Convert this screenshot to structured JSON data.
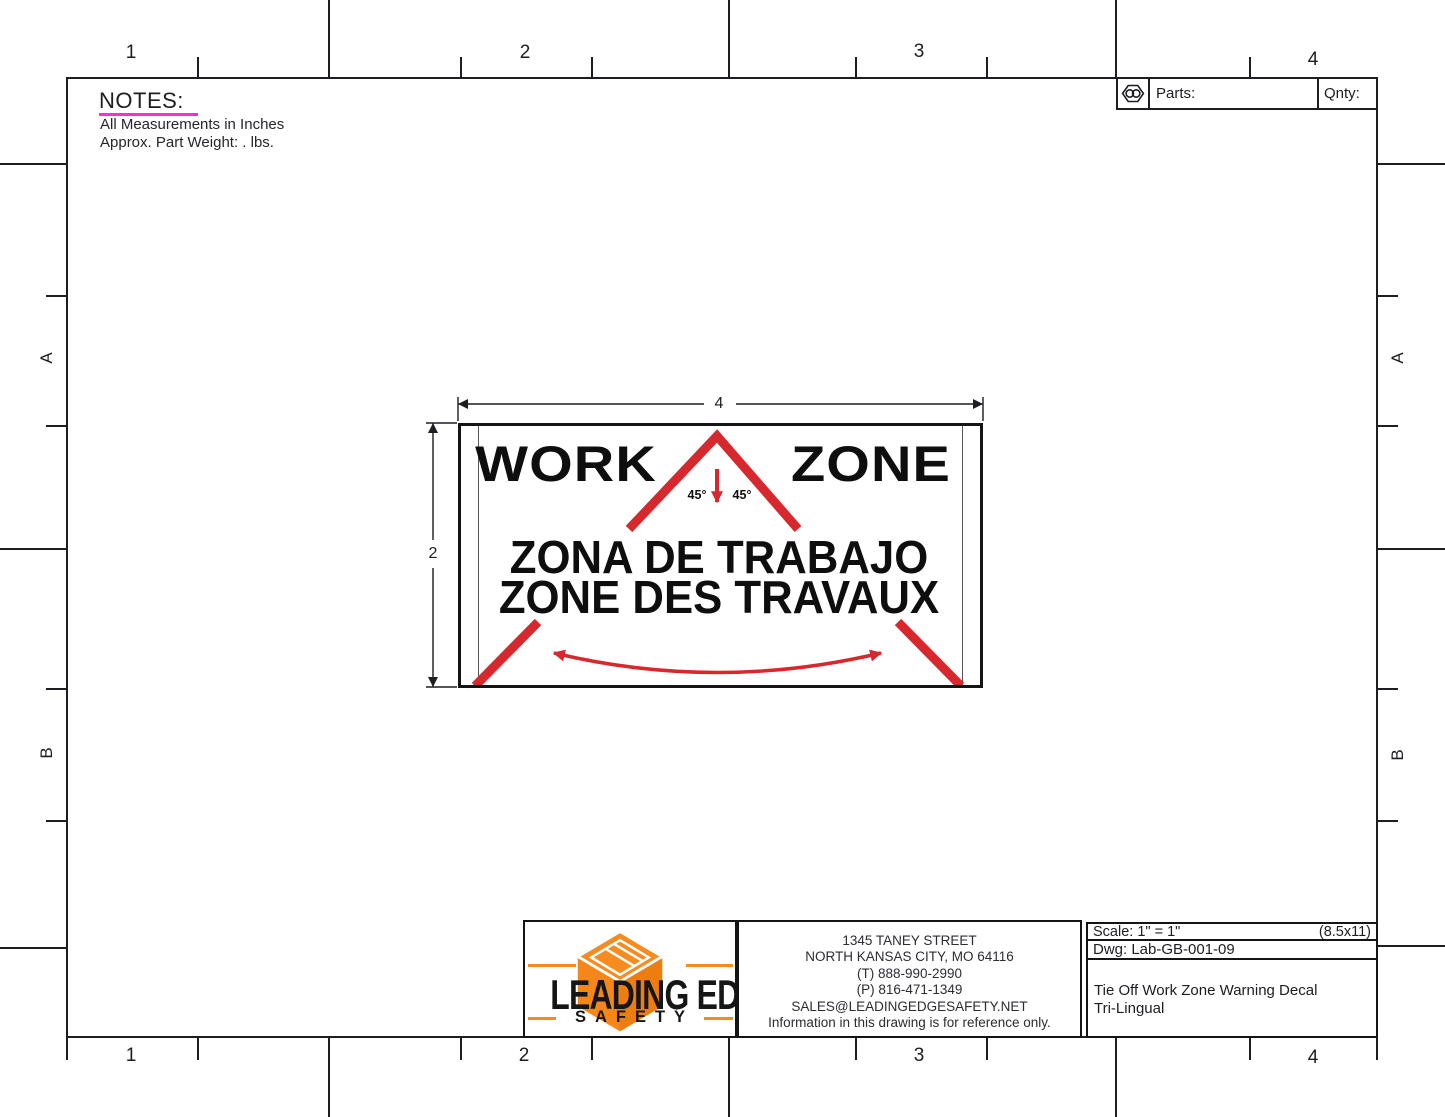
{
  "sheet": {
    "grid": {
      "cols": [
        "1",
        "2",
        "3",
        "4"
      ],
      "rows": [
        "A",
        "B"
      ]
    },
    "notes": {
      "heading": "NOTES:",
      "line1": "All Measurements in Inches",
      "line2": "Approx. Part Weight: . lbs."
    },
    "parts_block": {
      "parts_label": "Parts:",
      "qnty_label": "Qnty:"
    },
    "decal": {
      "word_left": "WORK",
      "word_right": "ZONE",
      "angle_left": "45°",
      "angle_right": "45°",
      "line2": "ZONA DE TRABAJO",
      "line3": "ZONE DES TRAVAUX",
      "dim_width": "4",
      "dim_height": "2"
    },
    "title_block": {
      "scale": "Scale: 1\" = 1\"",
      "sheet_size": "(8.5x11)",
      "dwg": "Dwg: Lab-GB-001-09",
      "title_line1": "Tie Off Work Zone Warning Decal",
      "title_line2": "Tri-Lingual"
    },
    "company": {
      "name": "LEADING EDGE",
      "sub": "SAFETY",
      "address1": "1345 TANEY STREET",
      "address2": "NORTH KANSAS CITY, MO 64116",
      "phone_t": "(T) 888-990-2990",
      "phone_p": "(P) 816-471-1349",
      "email": "SALES@LEADINGEDGESAFETY.NET",
      "disclaimer": "Information in this drawing is for reference only."
    },
    "colors": {
      "decal_red": "#d7282d",
      "brand_orange": "#f68b1f",
      "notes_underline": "#ff2bd6",
      "line_black": "#1d1d22"
    }
  }
}
